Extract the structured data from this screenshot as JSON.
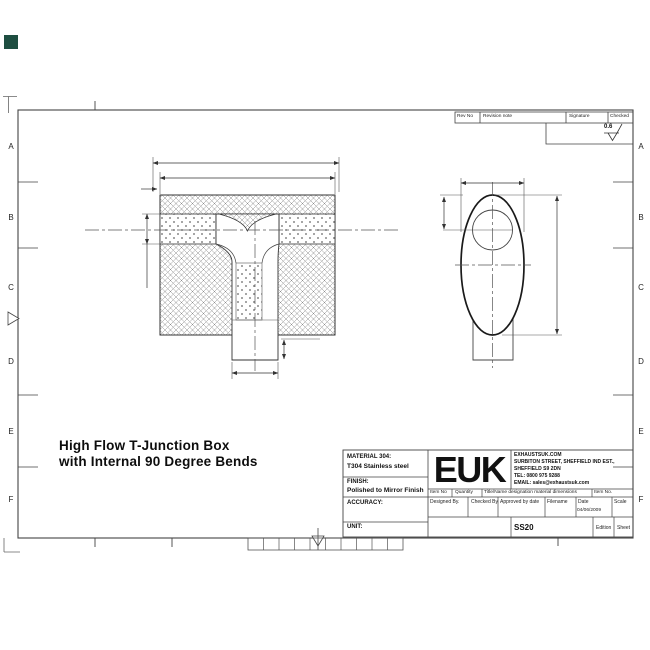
{
  "drawing": {
    "title_line1": "High Flow T-Junction Box",
    "title_line2": "with Internal 90 Degree Bends"
  },
  "border": {
    "rows_left": [
      "A",
      "B",
      "C",
      "D",
      "E",
      "F"
    ],
    "rows_right": [
      "A",
      "B",
      "C",
      "D",
      "E",
      "F"
    ]
  },
  "revision_table": {
    "rev_no": "Rev No",
    "revision_note": "Revision note",
    "signature": "Signature",
    "checked": "Checked",
    "surface_finish_value": "0.6"
  },
  "title_block": {
    "material_label": "MATERIAL 304:",
    "material_value": "T304 Stainless steel",
    "finish_label": "FINISH:",
    "finish_value": "Polished to Mirror Finish",
    "accuracy_label": "ACCURACY:",
    "unit_label": "UNIT:",
    "logo": "EUK",
    "company_line1": "EXHAUSTSUK.COM",
    "company_line2": "SURBITON STREET, SHEFFIELD IND EST.,",
    "company_line3": "SHEFFIELD S9 2DN",
    "company_line4": "TEL: 0800 975 9288",
    "company_line5": "EMAIL: sales@exhaustsuk.com",
    "item_no_label": "Item No",
    "quantity_label": "Quantity",
    "title_name_label": "Title/Name designation material dimensions",
    "item_no2_label": "Item No.",
    "designed_by_label": "Designed By.",
    "checked_by_label": "Checked By",
    "approved_label": "Approved by date",
    "filename_label": "Filename",
    "date_label": "Date",
    "date_value": "04/06/2009",
    "scale_label": "Scale",
    "part_number": "SS20",
    "edition_label": "Edition",
    "sheet_label": "Sheet"
  },
  "colors": {
    "accent_square": "#1e4e41",
    "line": "#333333"
  }
}
